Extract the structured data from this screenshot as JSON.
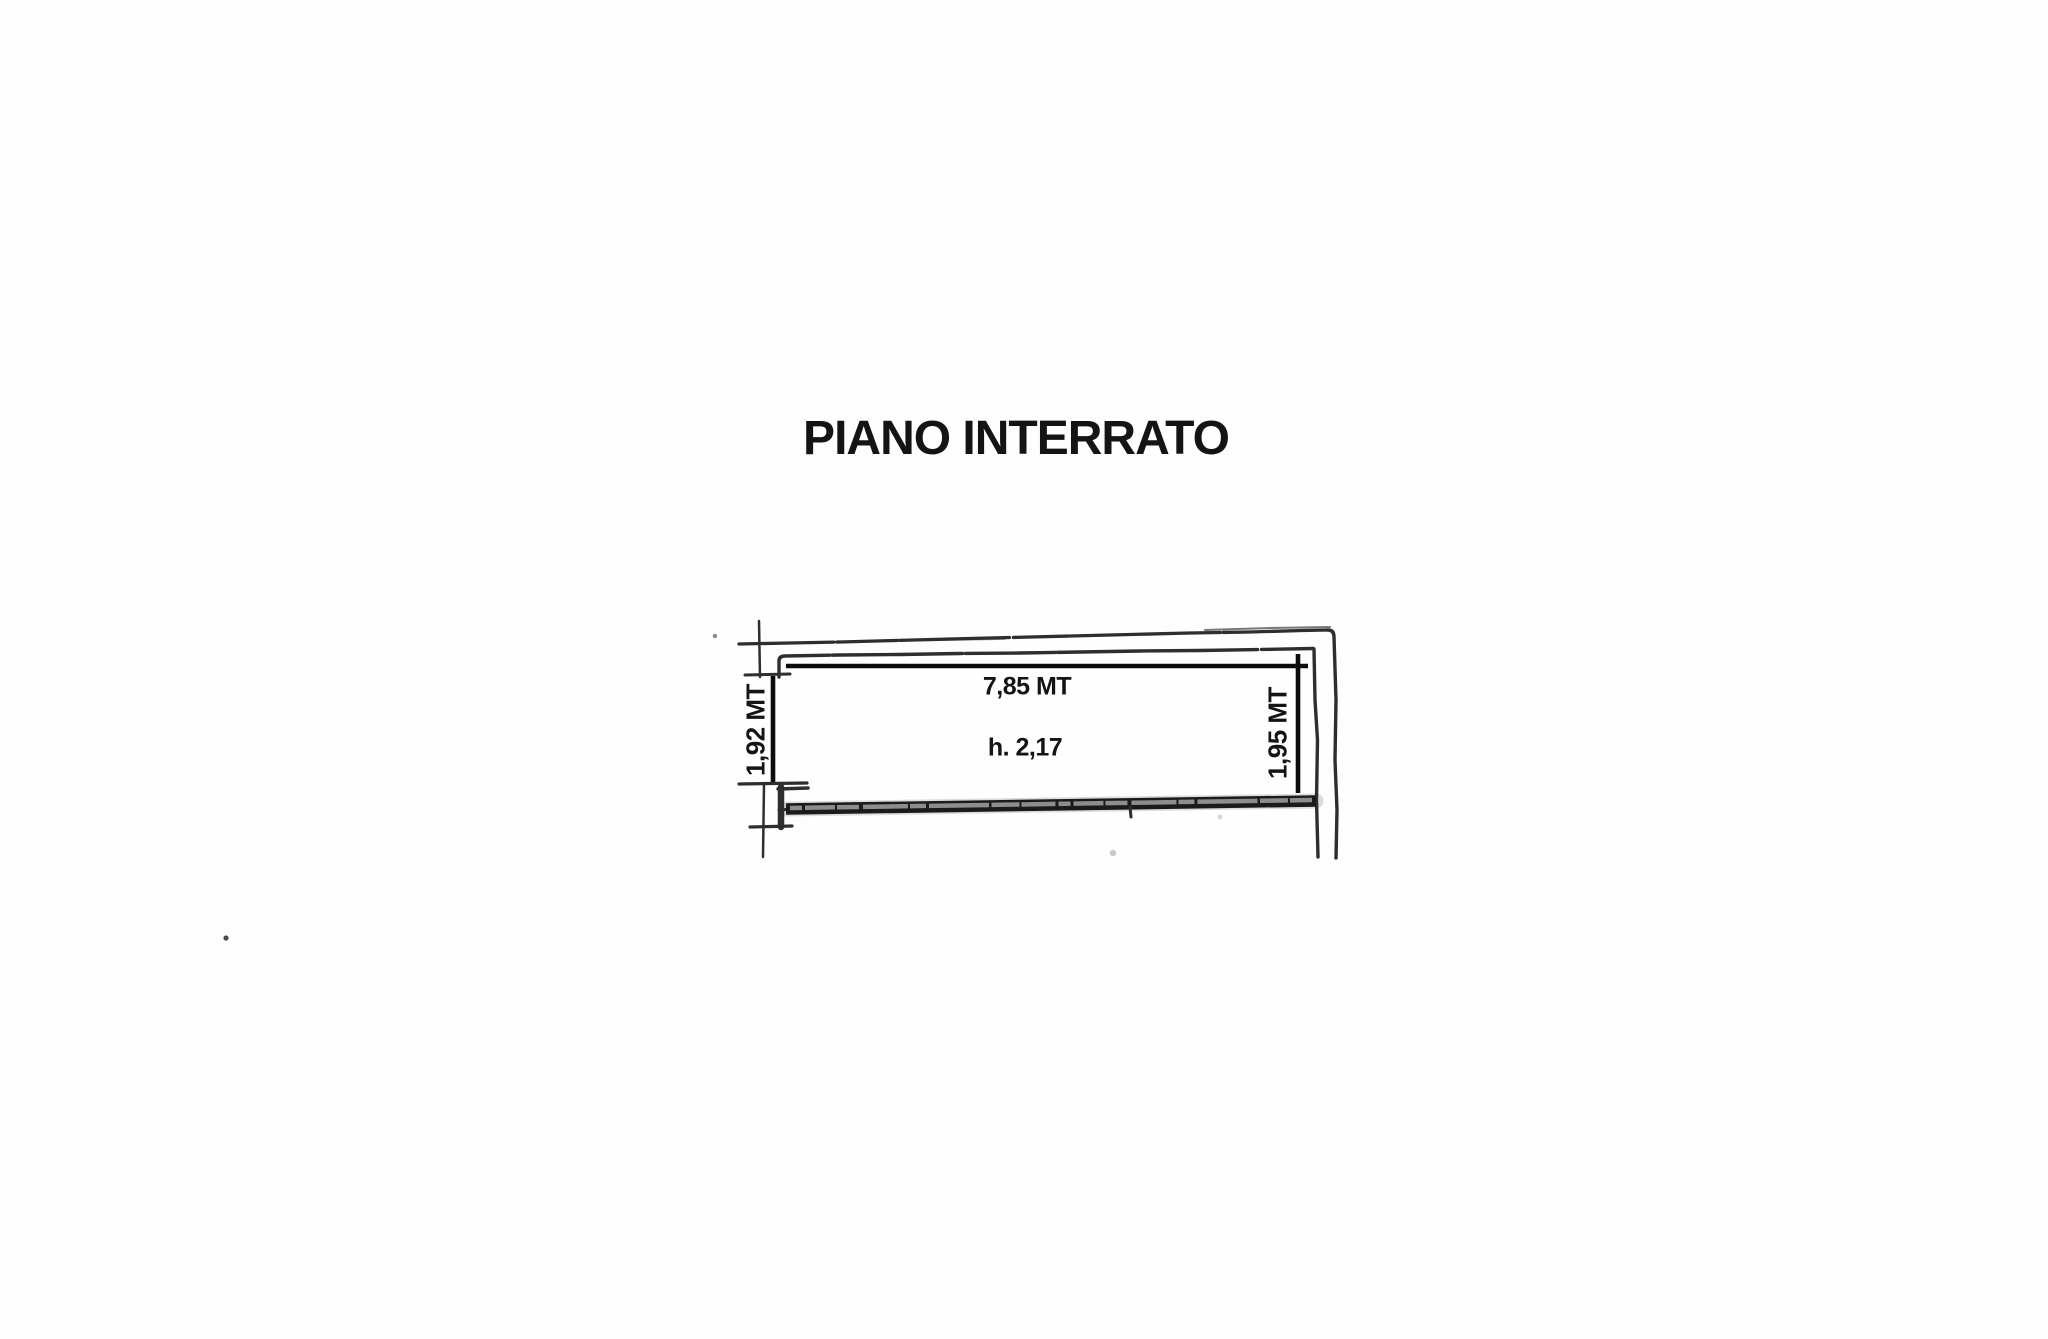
{
  "title": "PIANO INTERRATO",
  "floor_plan": {
    "width_label": "7,85 MT",
    "ceiling_height_label": "h. 2,17",
    "left_depth_label": "1,92 MT",
    "right_depth_label": "1,95 MT",
    "dimensions": {
      "width": {
        "value": "7,85",
        "unit": "MT"
      },
      "left_depth": {
        "value": "1,92",
        "unit": "MT"
      },
      "right_depth": {
        "value": "1,95",
        "unit": "MT"
      },
      "ceiling_height": {
        "value": "2,17",
        "unit": ""
      }
    }
  },
  "colors": {
    "page-bg": "#fefefe",
    "ink": "#2e2e2e",
    "dim-ink": "#0c0c0c",
    "wall-ink": "#1b1b1b",
    "text-ink": "#141414"
  }
}
